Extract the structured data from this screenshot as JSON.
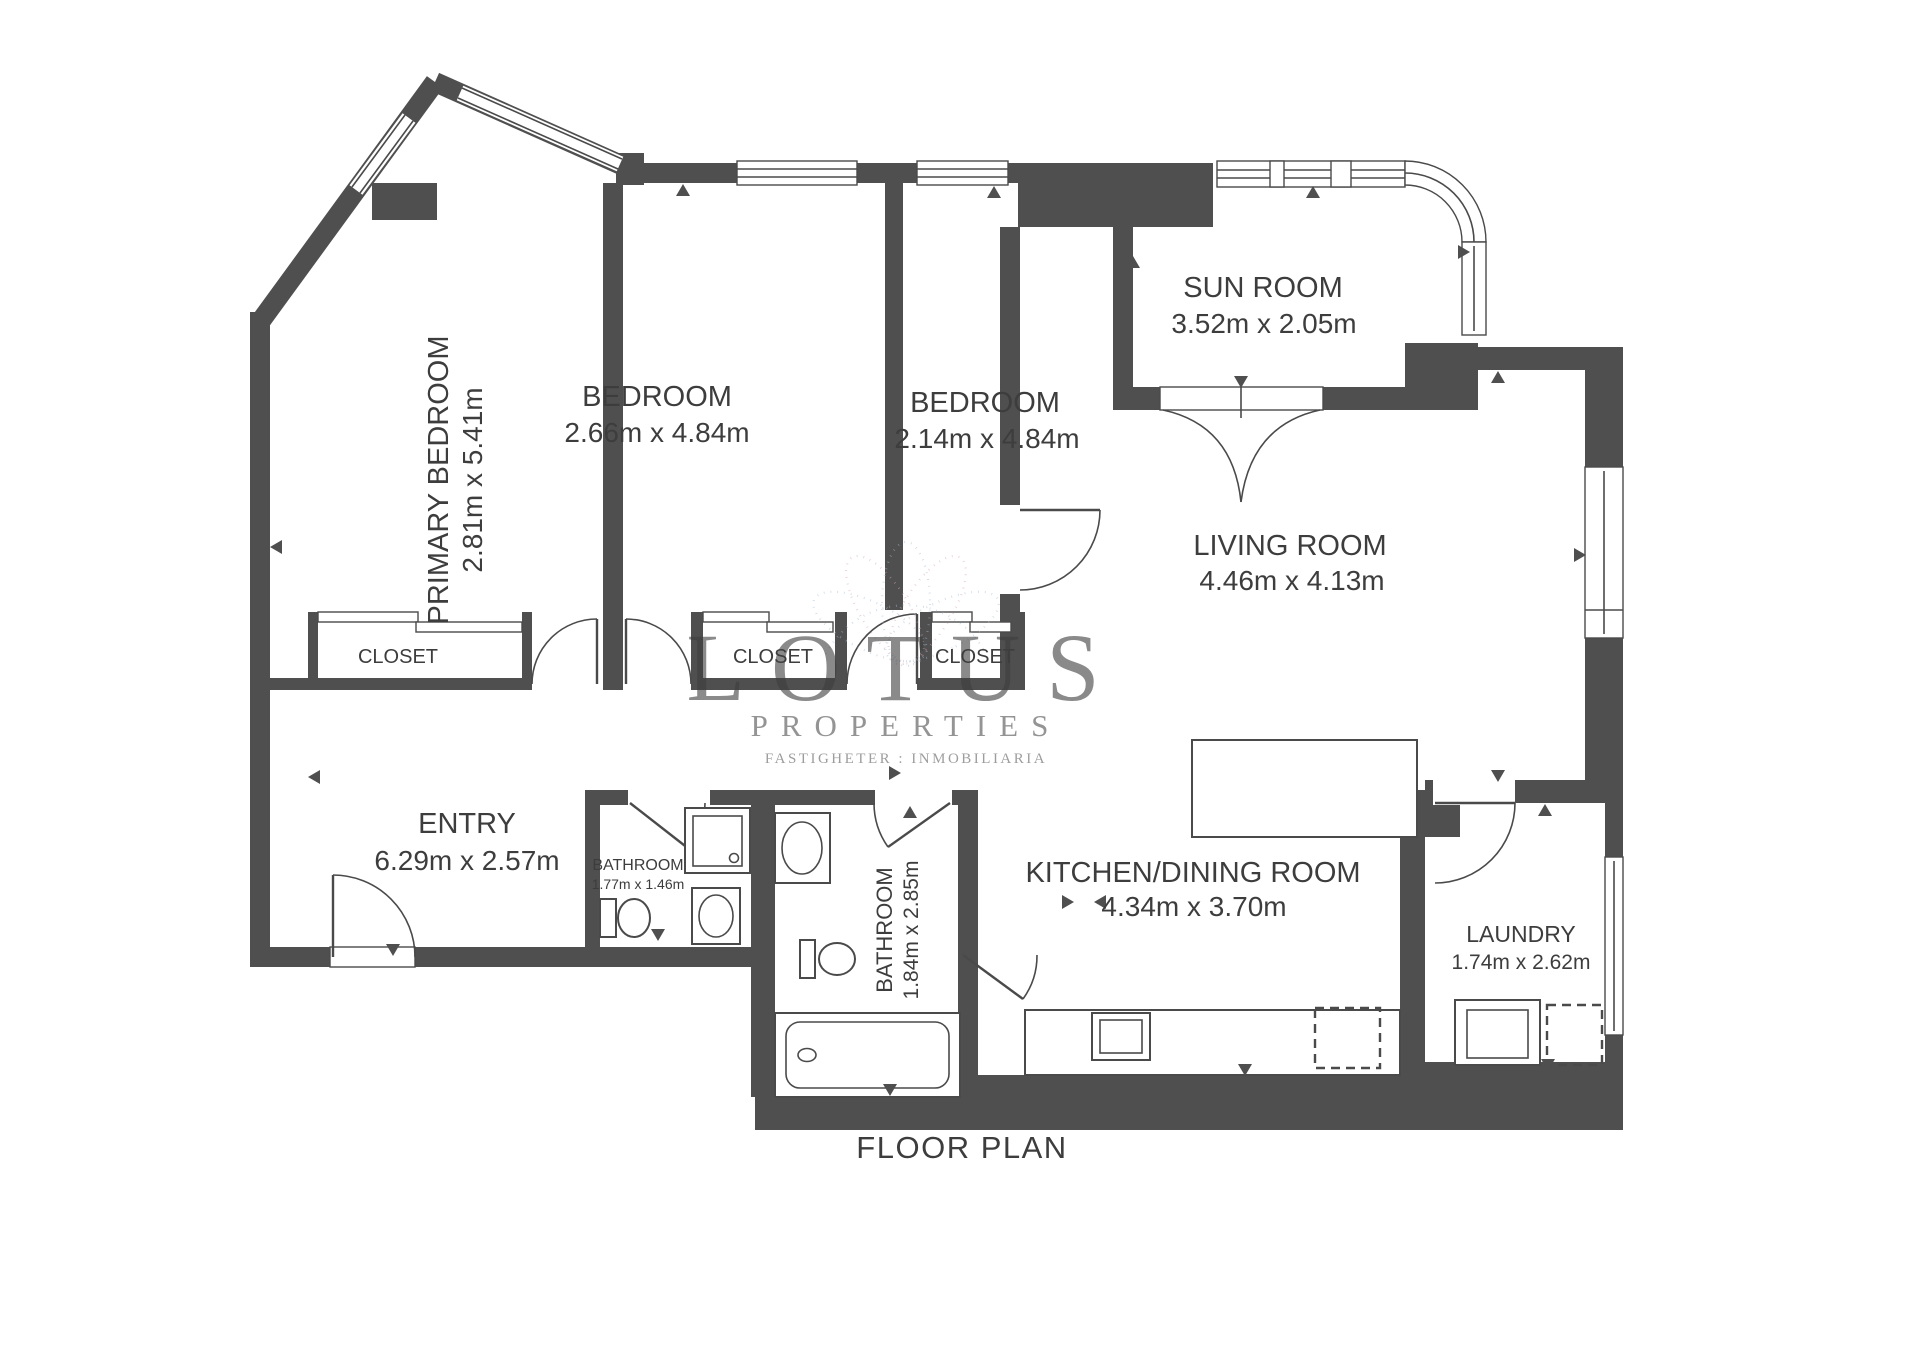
{
  "page": {
    "title": "FLOOR PLAN"
  },
  "watermark": {
    "brand": "LOTUS",
    "subtitle": "PROPERTIES",
    "tagline": "FASTIGHETER : INMOBILIARIA"
  },
  "colors": {
    "wall": "#4f4f4f",
    "label_text": "#3d3d3d",
    "watermark_text": "#97979d",
    "petal_blue": "#a9bccf",
    "petal_pink": "#d4a9b8"
  },
  "rooms": [
    {
      "name": "PRIMARY BEDROOM",
      "dims": "2.81m x 5.41m",
      "orientation": "vertical"
    },
    {
      "name": "BEDROOM",
      "dims": "2.66m x 4.84m",
      "orientation": "horizontal"
    },
    {
      "name": "BEDROOM",
      "dims": "2.14m x 4.84m",
      "orientation": "horizontal"
    },
    {
      "name": "SUN ROOM",
      "dims": "3.52m x 2.05m",
      "orientation": "horizontal"
    },
    {
      "name": "LIVING ROOM",
      "dims": "4.46m x 4.13m",
      "orientation": "horizontal"
    },
    {
      "name": "ENTRY",
      "dims": "6.29m x 2.57m",
      "orientation": "horizontal"
    },
    {
      "name": "BATHROOM",
      "dims": "1.77m x 1.46m",
      "orientation": "horizontal"
    },
    {
      "name": "BATHROOM",
      "dims": "1.84m x 2.85m",
      "orientation": "vertical"
    },
    {
      "name": "KITCHEN/DINING ROOM",
      "dims": "4.34m x 3.70m",
      "orientation": "horizontal"
    },
    {
      "name": "LAUNDRY",
      "dims": "1.74m x 2.62m",
      "orientation": "horizontal"
    }
  ],
  "closets": [
    {
      "label": "CLOSET"
    },
    {
      "label": "CLOSET"
    },
    {
      "label": "CLOSET"
    }
  ]
}
